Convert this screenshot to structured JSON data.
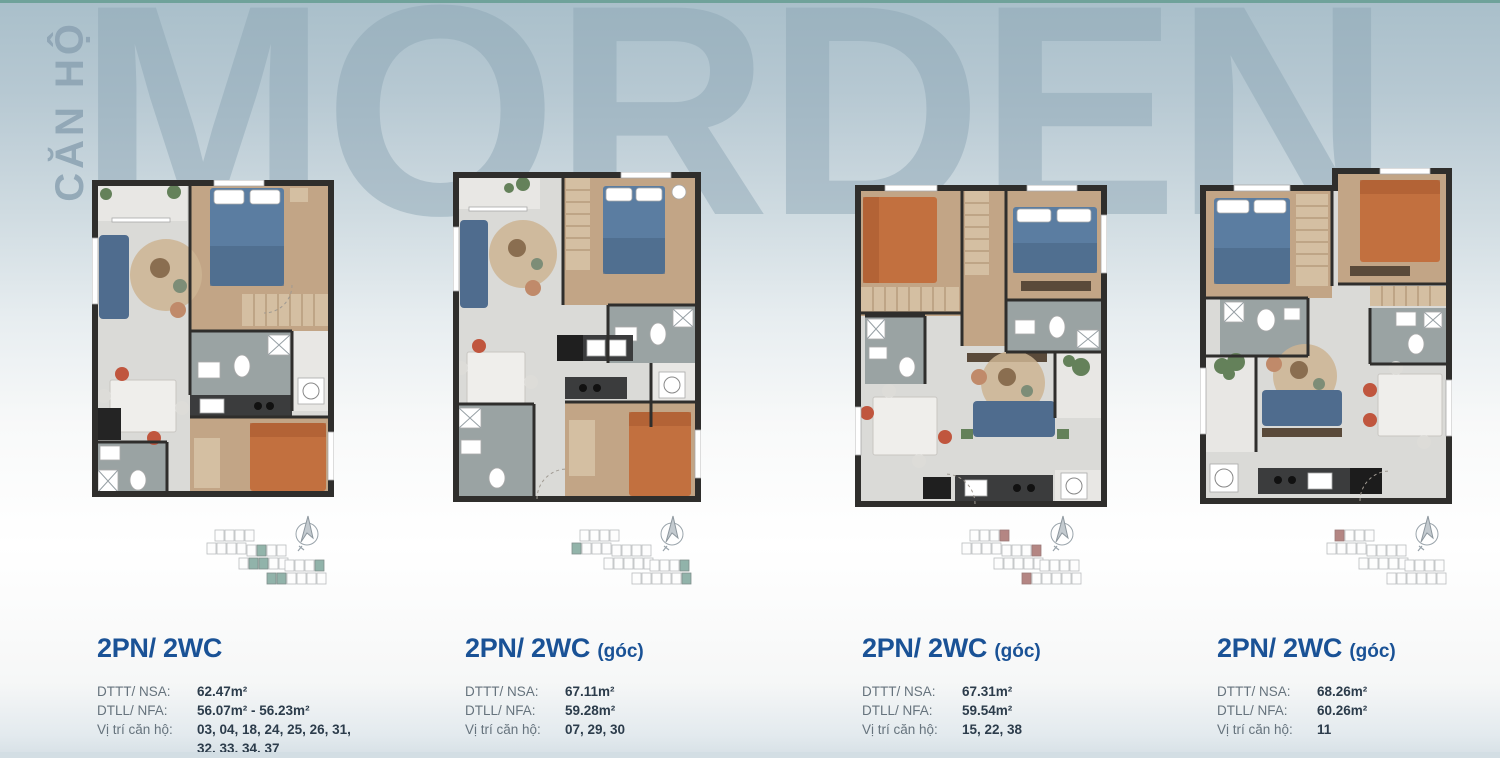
{
  "page": {
    "vertical_label": "CĂN HỘ",
    "watermark": "MORDEN",
    "accent_blue": "#1a5296",
    "teal_highlight": "#7fa79c",
    "red_highlight": "#a8716e"
  },
  "labels": {
    "nsa": "DTTT/ NSA:",
    "nfa": "DTLL/ NFA:",
    "position": "Vị trí căn hộ:"
  },
  "units": [
    {
      "title": "2PN/ 2WC",
      "suffix": "",
      "nsa": "62.47m²",
      "nfa": "56.07m² - 56.23m²",
      "positions": "03, 04, 18, 24, 25, 26, 31, 32, 33, 34, 37",
      "keyplan_highlight": "teal"
    },
    {
      "title": "2PN/ 2WC",
      "suffix": "(góc)",
      "nsa": "67.11m²",
      "nfa": "59.28m²",
      "positions": "07, 29, 30",
      "keyplan_highlight": "teal"
    },
    {
      "title": "2PN/ 2WC",
      "suffix": "(góc)",
      "nsa": "67.31m²",
      "nfa": "59.54m²",
      "positions": "15, 22, 38",
      "keyplan_highlight": "red"
    },
    {
      "title": "2PN/ 2WC",
      "suffix": "(góc)",
      "nsa": "68.26m²",
      "nfa": "60.26m²",
      "positions": "11",
      "keyplan_highlight": "red"
    }
  ]
}
